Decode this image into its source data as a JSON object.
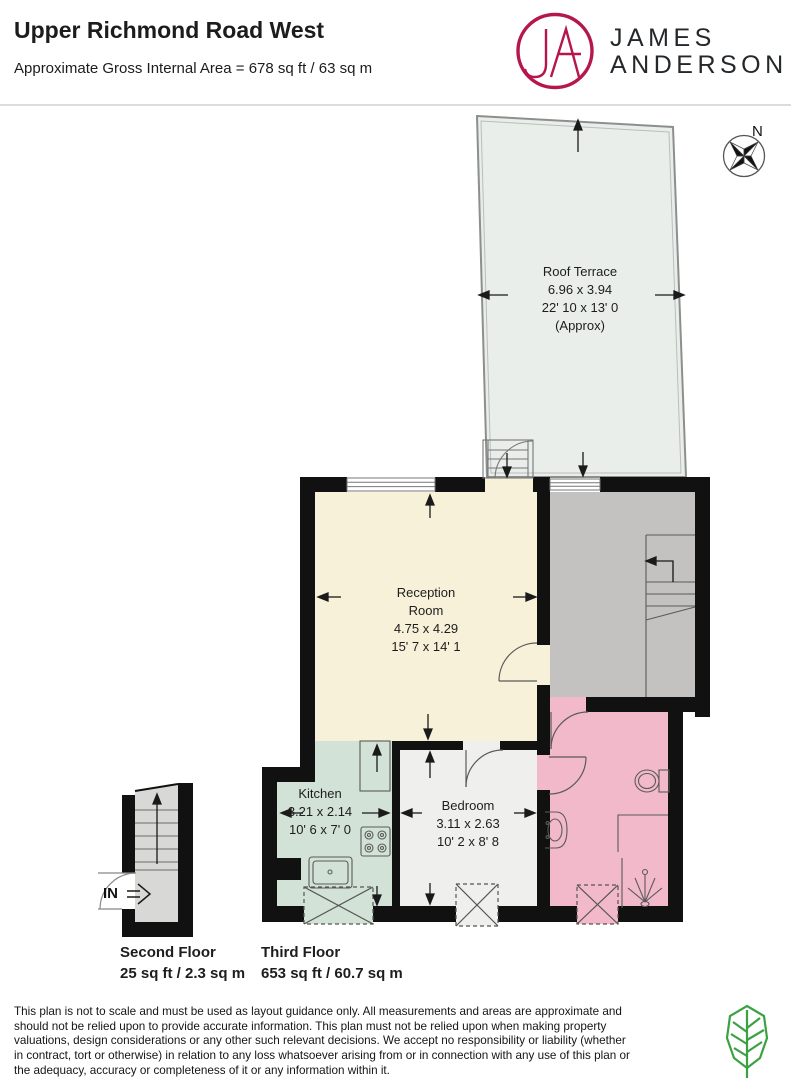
{
  "header": {
    "title": "Upper Richmond Road West",
    "subtitle": "Approximate Gross Internal Area = 678 sq ft / 63 sq m",
    "brand": {
      "monogram": "JA",
      "line1": "JAMES",
      "line2": "ANDERSON",
      "accent_color": "#B5164C",
      "text_color": "#24282B"
    }
  },
  "compass": {
    "north_label": "N"
  },
  "plan": {
    "rooms": {
      "roof_terrace": {
        "name": "Roof Terrace",
        "metric": "6.96 x 3.94",
        "imperial": "22' 10 x 13' 0",
        "note": "(Approx)",
        "fill": "#E9EEEB"
      },
      "reception": {
        "name_line1": "Reception",
        "name_line2": "Room",
        "metric": "4.75 x 4.29",
        "imperial": "15' 7 x 14' 1",
        "fill": "#F8F1D9"
      },
      "kitchen": {
        "name": "Kitchen",
        "metric": "3.21 x 2.14",
        "imperial": "10' 6 x 7' 0",
        "fill": "#D2E2D6"
      },
      "bedroom": {
        "name": "Bedroom",
        "metric": "3.11 x 2.63",
        "imperial": "10' 2 x 8' 8",
        "fill": "#EFEFED"
      },
      "bathroom": {
        "fill": "#F2B9CB"
      },
      "landing": {
        "fill": "#C3C2C0"
      }
    },
    "entrance_label": "IN",
    "floors": [
      {
        "name": "Second Floor",
        "area": "25 sq ft / 2.3 sq m"
      },
      {
        "name": "Third Floor",
        "area": "653 sq ft / 60.7 sq m"
      }
    ],
    "wall_color": "#111111"
  },
  "footer": {
    "disclaimer": "This plan is not to scale and must be used as layout guidance only. All measurements and areas are approximate and should not be relied upon to provide accurate information. This plan must not be relied upon when making property valuations, design considerations or any other such relevant decisions. We accept no responsibility or liability (whether in contract, tort or otherwise) in relation to any loss whatsoever arising from or in connection with any use of this plan or the adequacy, accuracy or completeness of it or any information within it.",
    "leaf_icon_color": "#3BA143"
  }
}
